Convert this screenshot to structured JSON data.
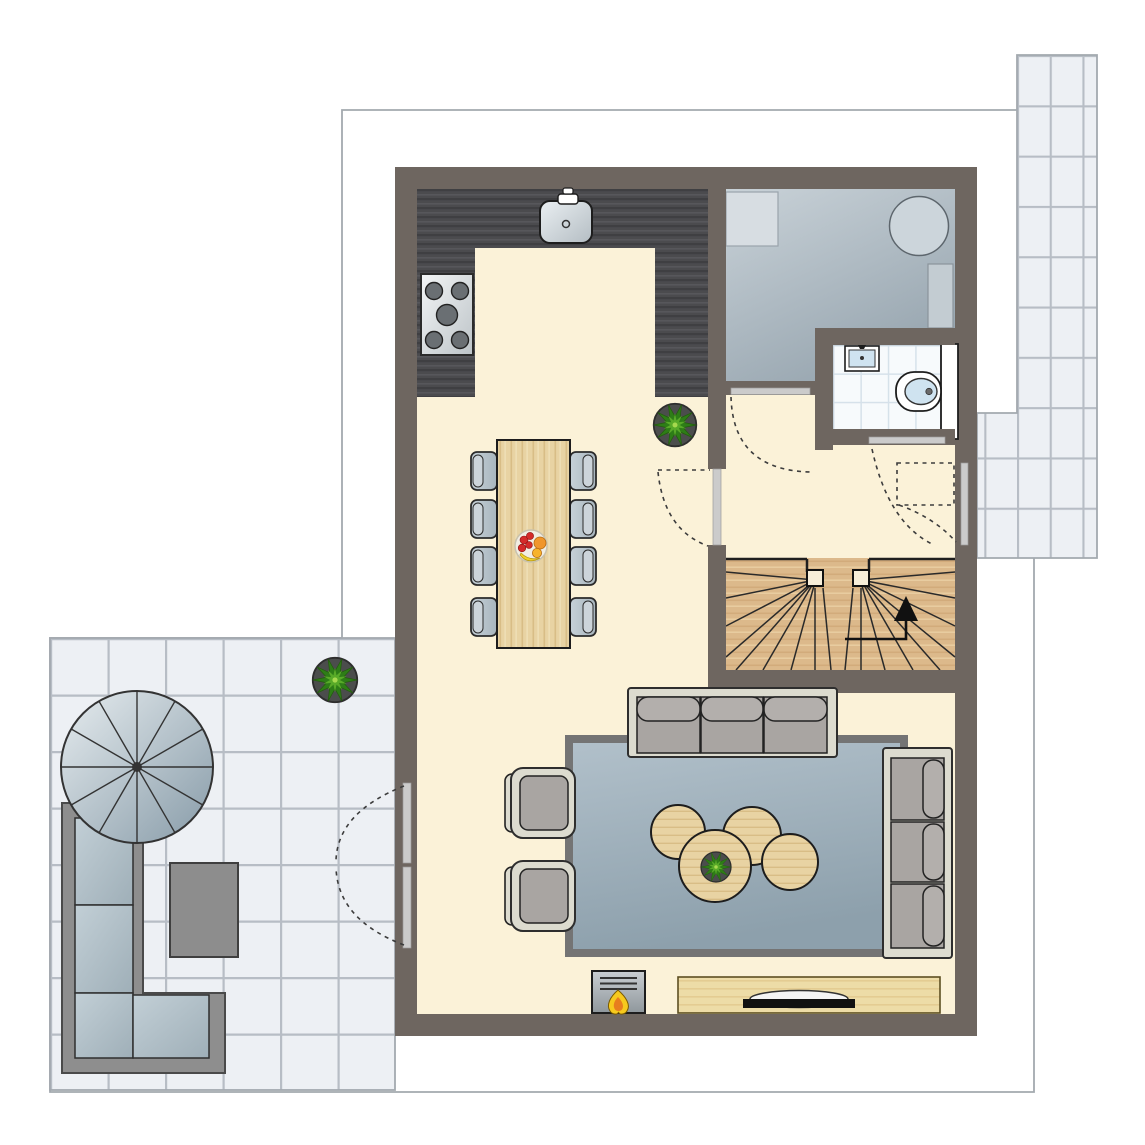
{
  "document": {
    "type": "architectural-floor-plan",
    "title": "Ground floor plan (no visible text labels in drawing)",
    "background": "#ffffff"
  },
  "palette": {
    "wall": "#6e6660",
    "floor": "#fbf2d8",
    "counter": "#4b4b4e",
    "counterDark": "#3f3f42",
    "counterLight": "#57575b",
    "tile": "#edf0f4",
    "grout": "#b7bdc5",
    "boundary": "#a3a9af",
    "utilTop": "#c9d2d8",
    "utilBottom": "#98a6b0",
    "bathTile": "#f7fafc",
    "bathGrout": "#d6e1ea",
    "stairWood": "#dcb98b",
    "stairGrain": "#c79e6c",
    "rugBorder": "#747474",
    "rugTop": "#b1c0ca",
    "rugBottom": "#8da0ac",
    "frame": "#dcdbcf",
    "cushion": "#a9a5a2",
    "pillow": "#b3afac",
    "woodLight": "#e8d3a3",
    "woodGrain": "#d8bd86",
    "tvBoard": "#eddca7",
    "chair": "#b4c0c8",
    "chairLight": "#ccd4da",
    "sofaOutFrame": "#8e8e8e",
    "terraceTable": "#8d8d8d",
    "windowBar": "#cbcbcb",
    "dash": "#3c3c3c",
    "ink": "#222222",
    "plantDark": "#2e7d17",
    "plantLight": "#58aa28",
    "plantPot": "#4b4d4c",
    "flameYellow": "#f6c91e",
    "flameOrange": "#e77e1e",
    "applianceLight": "#d7dde2",
    "applianceMid": "#ccd5db",
    "applianceRect": "#c3ccd2",
    "fixtureBlue": "#cfe3f0",
    "fruitRed": "#d42a2a",
    "fruitOrange": "#f0962c",
    "fruitYellow": "#f2d22e"
  },
  "rooms": [
    {
      "name": "kitchen",
      "floor": "dark wood counters on cream floor"
    },
    {
      "name": "dining-area",
      "floor": "cream"
    },
    {
      "name": "living-area",
      "floor": "cream with blue-gray rug"
    },
    {
      "name": "hallway",
      "floor": "cream"
    },
    {
      "name": "utility-room",
      "floor": "blue-gray"
    },
    {
      "name": "bathroom",
      "floor": "white tiles"
    },
    {
      "name": "staircase",
      "floor": "light wood winder stair with up arrow"
    },
    {
      "name": "terrace",
      "floor": "large light gray tiles"
    },
    {
      "name": "garden-path",
      "floor": "light gray tiles"
    }
  ],
  "fixtures": {
    "cooktop_burners": 5,
    "kitchen_sink": 1,
    "washbasin": 1,
    "toilet": 1,
    "utility_appliances": 3,
    "interior_doors": 3,
    "french_doors": 2,
    "windows": 2,
    "stair_direction_arrow": "up"
  },
  "furniture": {
    "dining_table_seats": 8,
    "dining_chairs": 8,
    "fruit_bowl": 1,
    "three_seat_sofas": 2,
    "armchairs": 2,
    "round_coffee_tables": 4,
    "rug": 1,
    "fireplace_stove": 1,
    "tv_lowboard": 1,
    "television": 1,
    "potted_plants": 3,
    "spiral_staircase": 1,
    "outdoor_corner_sofa": 1,
    "outdoor_table": 1
  }
}
